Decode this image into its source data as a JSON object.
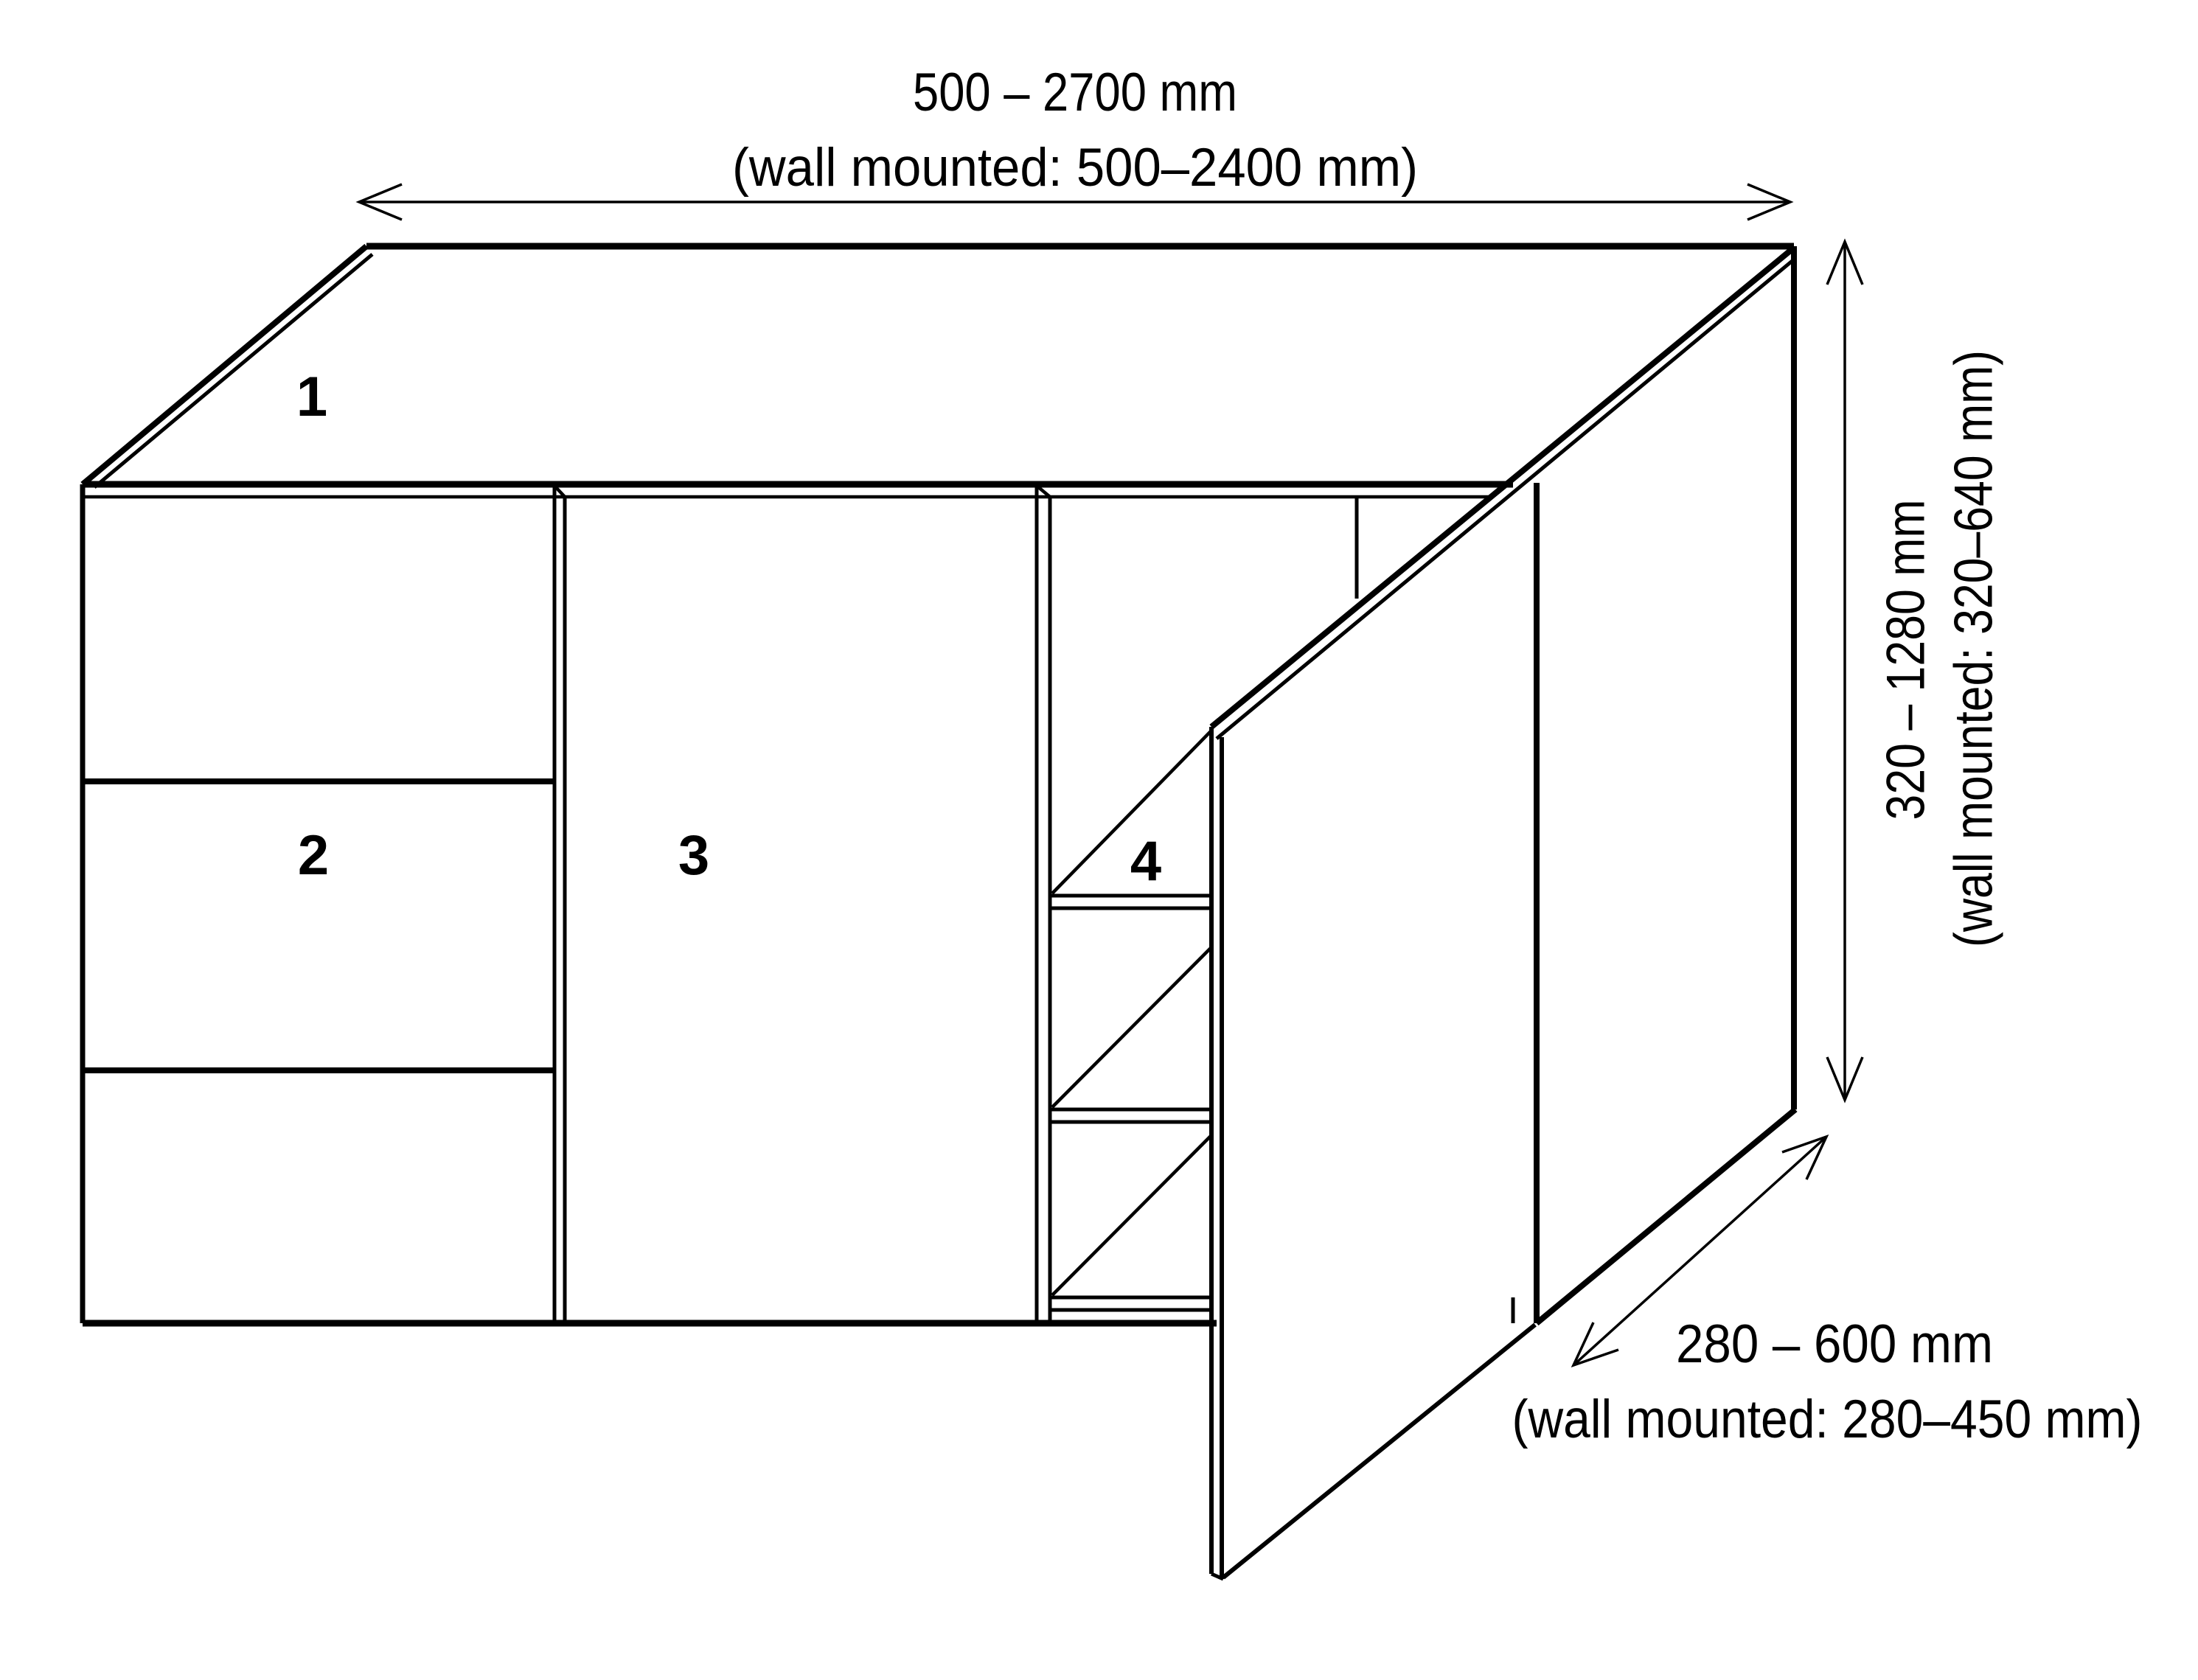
{
  "diagram_title": "cabinet dimension diagram",
  "colors": {
    "line": "#000000",
    "background": "#ffffff"
  },
  "dimensions": {
    "width": {
      "range": "500 – 2700 mm",
      "wall_mounted": "(wall mounted: 500–2400 mm)"
    },
    "height": {
      "range": "320 – 1280 mm",
      "wall_mounted": "(wall mounted: 320–640 mm)"
    },
    "depth": {
      "range": "280 – 600 mm",
      "wall_mounted": "(wall mounted: 280–450 mm)"
    }
  },
  "part_labels": [
    {
      "number": "1",
      "part": "top-panel"
    },
    {
      "number": "2",
      "part": "drawer-front"
    },
    {
      "number": "3",
      "part": "door-front"
    },
    {
      "number": "4",
      "part": "open-shelf-compartment"
    }
  ]
}
